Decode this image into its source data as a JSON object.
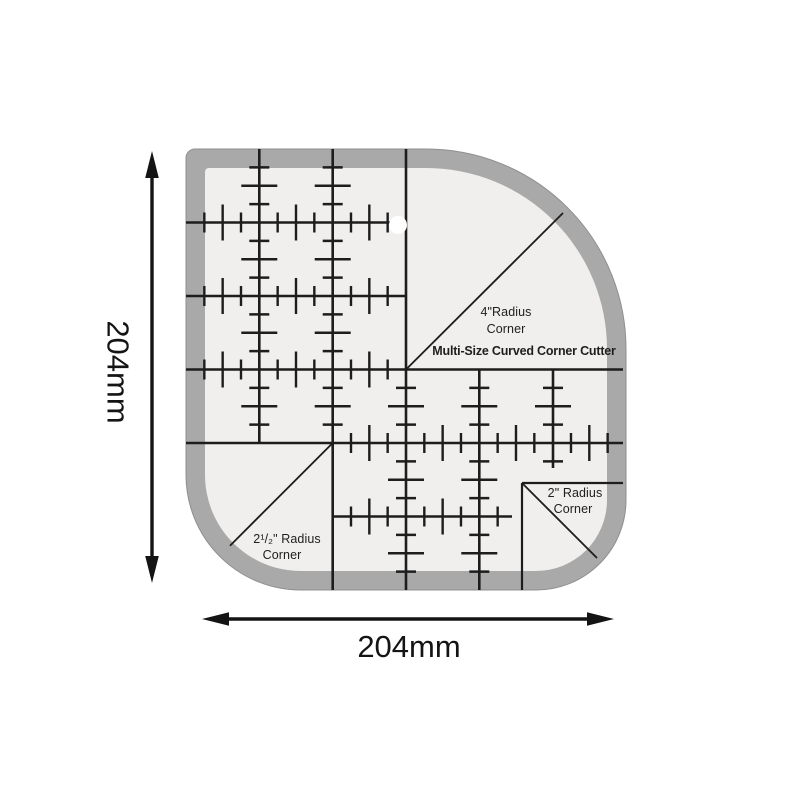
{
  "labels": {
    "brand": "Multi-Size Curved Corner Cutter",
    "corner_4": {
      "line1": "4\"Radius",
      "line2": "Corner"
    },
    "corner_2_5": {
      "line1": "2¹/₂\" Radius",
      "line2": "Corner"
    },
    "corner_2": {
      "line1": "2\" Radius",
      "line2": "Corner"
    }
  },
  "dimensions": {
    "height": "204mm",
    "width": "204mm"
  },
  "colors": {
    "background": "#ffffff",
    "band": "#a9a9a9",
    "band_edge": "#8f8f8f",
    "face": "#f0efed",
    "line": "#1d1d1d",
    "text": "#1e1e1e",
    "dimension": "#141414"
  },
  "geometry": {
    "outer": {
      "left": 186,
      "top": 149,
      "right": 626,
      "bottom": 590,
      "radius_top_left": 9,
      "radius_top_right": 200,
      "radius_bottom_right": 90,
      "radius_bottom_left": 115
    },
    "band_width": 19,
    "inner_radii": {
      "top_left": 4,
      "top_right": 181,
      "bottom_right": 71,
      "bottom_left": 96
    },
    "grid": {
      "origin_x": 186,
      "origin_y": 149,
      "unit_x": 73.33,
      "unit_y": 73.5
    },
    "tick_short": 20,
    "tick_long": 36,
    "rulers_h": [
      {
        "y": 222.5,
        "from": 186,
        "to": 407,
        "tick_from": 186,
        "tick_to": 406
      },
      {
        "y": 296,
        "from": 186,
        "to": 407,
        "tick_from": 186,
        "tick_to": 406
      },
      {
        "y": 369.5,
        "from": 186,
        "to": 623,
        "tick_from": 186,
        "tick_to": 406
      },
      {
        "y": 443,
        "from": 186,
        "to": 623,
        "tick_from": 333,
        "tick_to": 620
      },
      {
        "y": 516.5,
        "from": 333,
        "to": 512,
        "tick_from": 333,
        "tick_to": 506
      },
      {
        "y": 483,
        "from": 522,
        "to": 623,
        "tick_from": 0,
        "tick_to": 0
      }
    ],
    "rulers_v": [
      {
        "x": 259.3,
        "from": 149,
        "to": 443,
        "tick_from": 149,
        "tick_to": 443
      },
      {
        "x": 332.7,
        "from": 149,
        "to": 590,
        "tick_from": 149,
        "tick_to": 443
      },
      {
        "x": 406,
        "from": 149,
        "to": 590,
        "tick_from": 369.5,
        "tick_to": 590
      },
      {
        "x": 479.3,
        "from": 369.5,
        "to": 590,
        "tick_from": 369.5,
        "tick_to": 590
      },
      {
        "x": 553,
        "from": 369.5,
        "to": 468,
        "tick_from": 369.5,
        "tick_to": 466
      },
      {
        "x": 522,
        "from": 483,
        "to": 590,
        "tick_from": 0,
        "tick_to": 0
      }
    ],
    "diagonals": [
      {
        "x1": 406,
        "y1": 369.5,
        "x2": 563,
        "y2": 213
      },
      {
        "x1": 332.7,
        "y1": 443,
        "x2": 230,
        "y2": 545.7
      },
      {
        "x1": 522,
        "y1": 483,
        "x2": 597,
        "y2": 558
      }
    ],
    "hole": {
      "cx": 398,
      "cy": 225,
      "r": 9
    }
  }
}
